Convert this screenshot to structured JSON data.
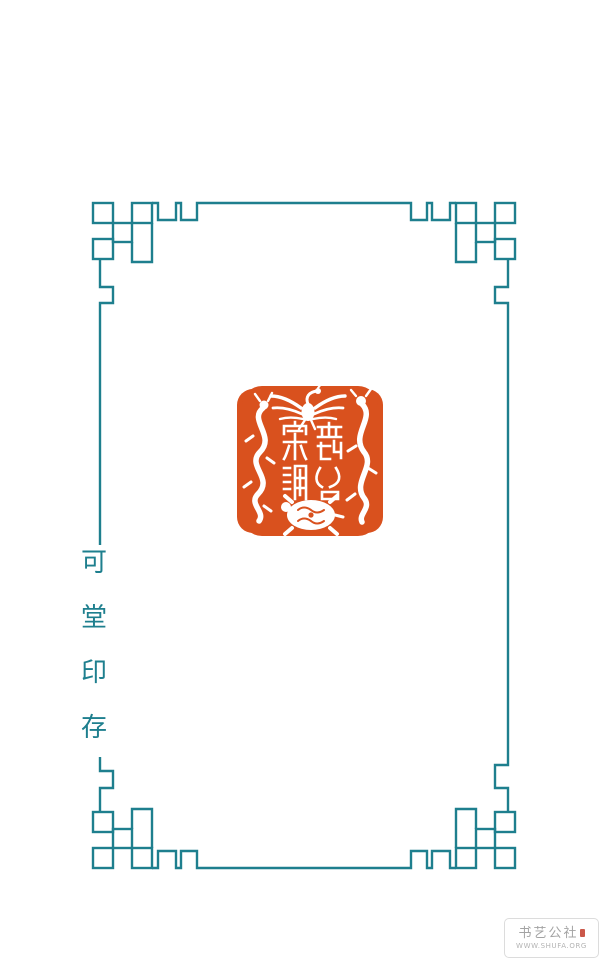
{
  "colors": {
    "background": "#ffffff",
    "border_teal": "#1e7f8e",
    "seal_red": "#d9511e",
    "label_teal": "#1e7f8e",
    "watermark_text": "#a3a3a3",
    "watermark_url": "#b3b3b3",
    "watermark_border": "#dcdcdc",
    "watermark_mark_red": "#c23b2a"
  },
  "side_label": {
    "text": "可堂印存",
    "orientation": "vertical",
    "chars": [
      "可",
      "堂",
      "印",
      "存"
    ]
  },
  "seal": {
    "description": "Square vermilion seal impression, white intaglio carving of the four spirit creatures around seal-script characters",
    "motifs": [
      "phoenix-top",
      "dragon-left",
      "tiger-right",
      "tortoise-bottom",
      "seal-script-characters-center"
    ]
  },
  "watermark": {
    "site_name": "书艺公社",
    "site_url": "WWW.SHUFA.ORG"
  }
}
